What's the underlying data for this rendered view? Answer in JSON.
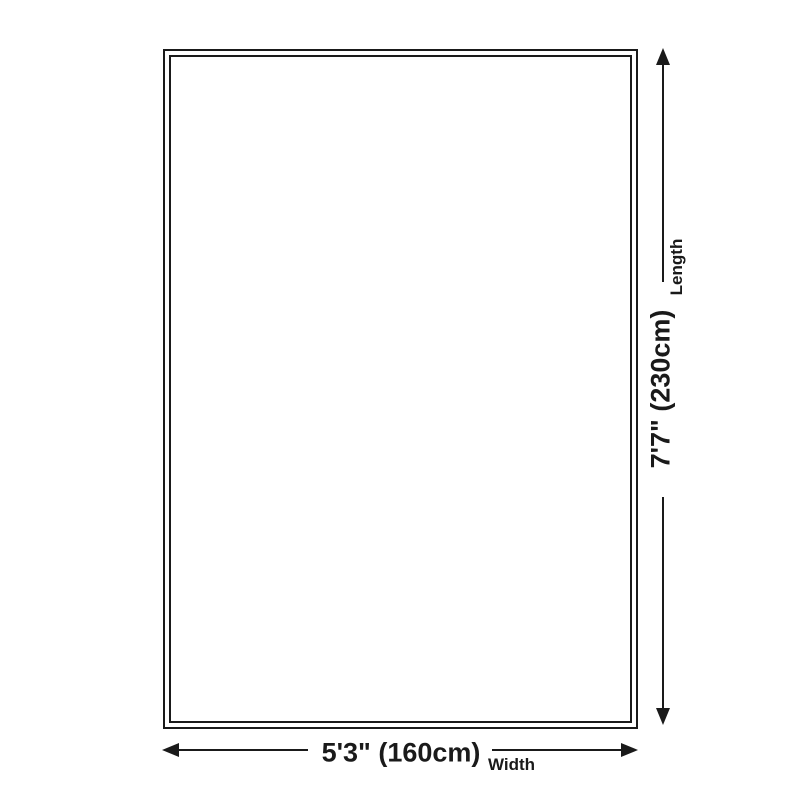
{
  "diagram": {
    "length_dim": {
      "value": "7'7\" (230cm)",
      "label": "Length"
    },
    "width_dim": {
      "value": "5'3\" (160cm)",
      "label": "Width"
    },
    "colors": {
      "ink": "#1a1a1a",
      "background": "#ffffff"
    }
  }
}
